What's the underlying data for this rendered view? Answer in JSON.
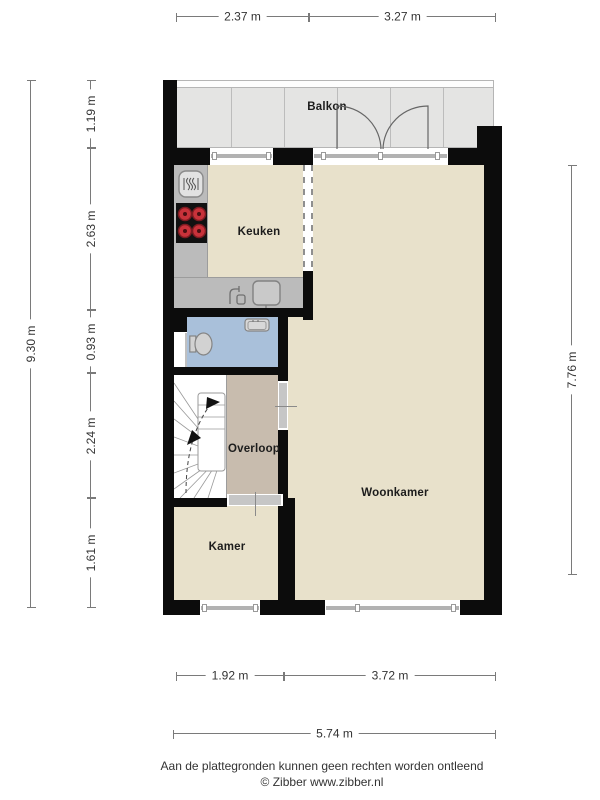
{
  "rooms": {
    "balkon": "Balkon",
    "keuken": "Keuken",
    "overloop": "Overloop",
    "kamer": "Kamer",
    "woonkamer": "Woonkamer"
  },
  "dimensions": {
    "top": [
      {
        "label": "2.37 m"
      },
      {
        "label": "3.27 m"
      }
    ],
    "left_total": {
      "label": "9.30 m"
    },
    "left_segments": [
      {
        "label": "1.19 m"
      },
      {
        "label": "2.63 m"
      },
      {
        "label": "0.93 m"
      },
      {
        "label": "2.24 m"
      },
      {
        "label": "1.61 m"
      }
    ],
    "right_total": {
      "label": "7.76 m"
    },
    "bottom": [
      {
        "label": "1.92 m"
      },
      {
        "label": "3.72 m"
      }
    ],
    "bottom_total": {
      "label": "5.74 m"
    }
  },
  "footer": {
    "disclaimer": "Aan de plattegronden kunnen geen rechten worden ontleend",
    "credit": "© Zibber www.zibber.nl"
  },
  "colors": {
    "wall_black": "#0c0c0c",
    "floor_beige": "#e8e1cb",
    "balcony_gray": "#e4e4e3",
    "bathroom_blue": "#a9c0da",
    "overloop_tan": "#c8bcae",
    "counter_gray": "#bbbbbb",
    "burner_red": "#c8323a"
  }
}
